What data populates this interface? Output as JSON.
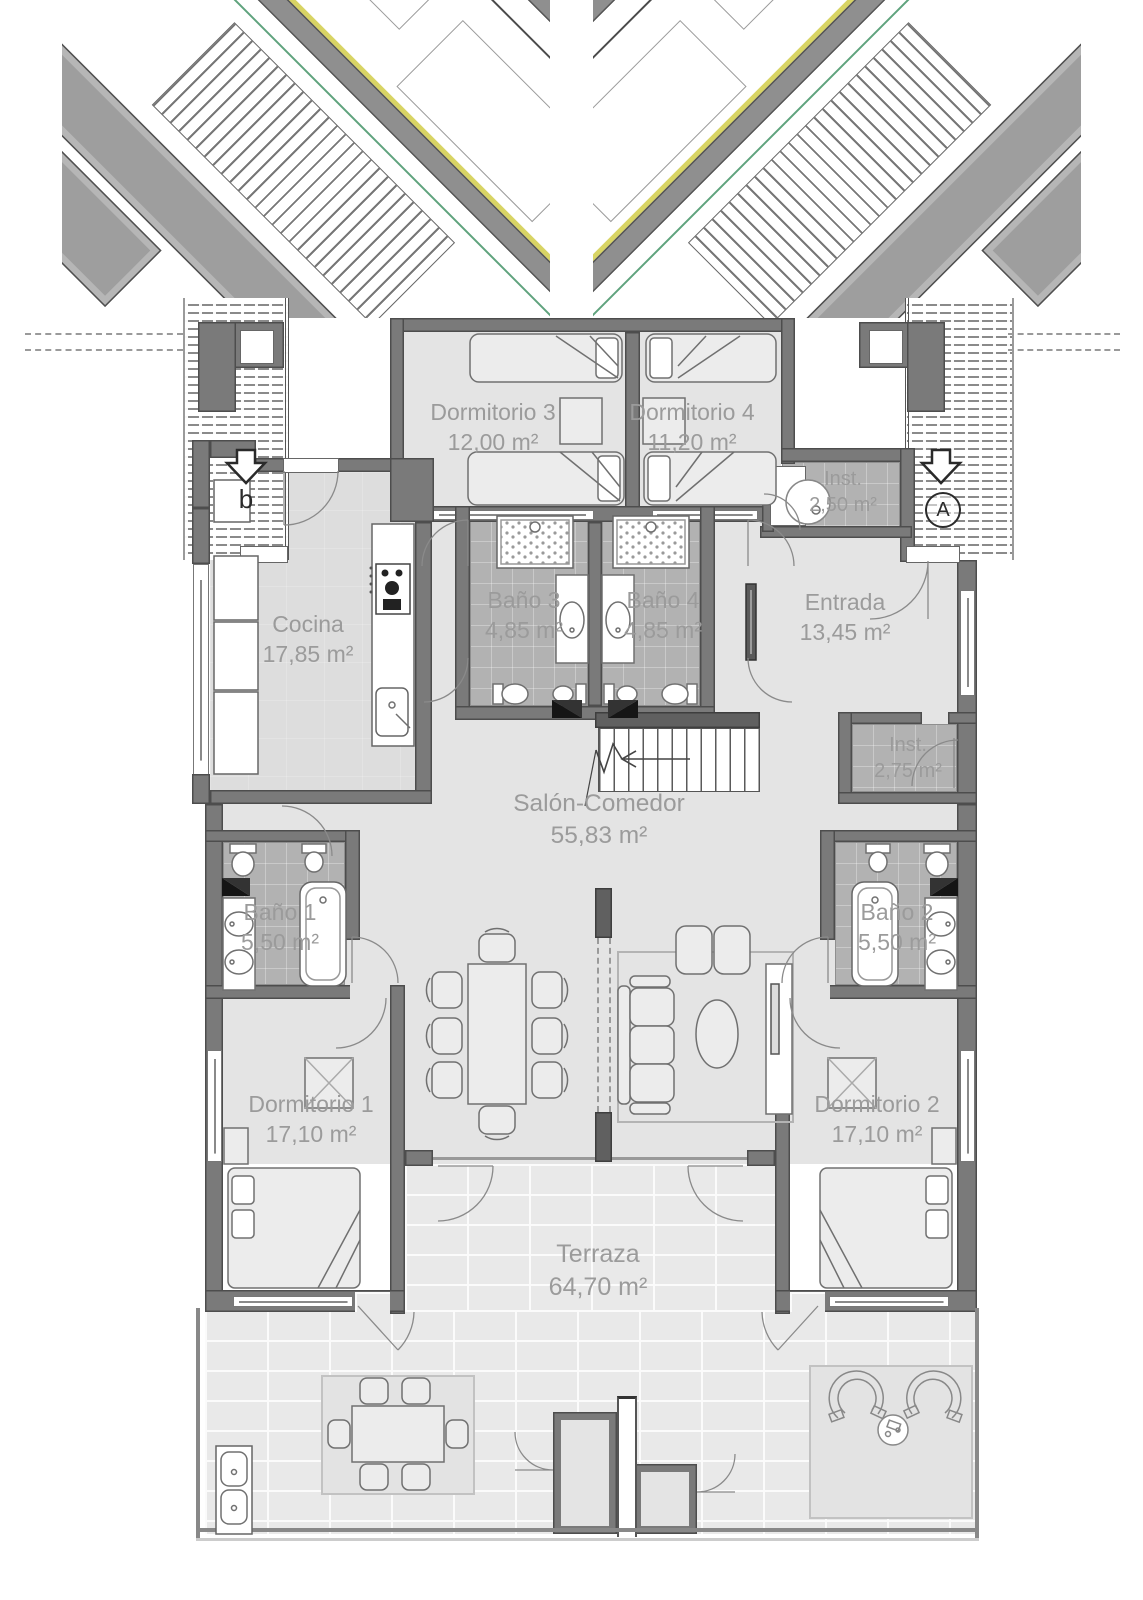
{
  "plan": {
    "title": "apartment-floor-plan",
    "markers": {
      "left": {
        "letter": "b",
        "icon": "down-arrow-icon"
      },
      "right": {
        "letter": "A",
        "icon": "down-arrow-icon"
      }
    },
    "rooms": [
      {
        "id": "dormitorio-3",
        "name": "Dormitorio 3",
        "area": "12,00 m²"
      },
      {
        "id": "dormitorio-4",
        "name": "Dormitorio 4",
        "area": "11,20 m²"
      },
      {
        "id": "inst-top",
        "name": "Inst.",
        "area": "2,50 m²"
      },
      {
        "id": "cocina",
        "name": "Cocina",
        "area": "17,85 m²"
      },
      {
        "id": "bano-3",
        "name": "Baño 3",
        "area": "4,85 m²"
      },
      {
        "id": "bano-4",
        "name": "Baño 4",
        "area": "4,85 m²"
      },
      {
        "id": "entrada",
        "name": "Entrada",
        "area": "13,45 m²"
      },
      {
        "id": "inst-mid",
        "name": "Inst.",
        "area": "2,75 m²"
      },
      {
        "id": "salon-comedor",
        "name": "Salón-Comedor",
        "area": "55,83 m²"
      },
      {
        "id": "bano-1",
        "name": "Baño 1",
        "area": "5,50 m²"
      },
      {
        "id": "bano-2",
        "name": "Baño 2",
        "area": "5,50 m²"
      },
      {
        "id": "dormitorio-1",
        "name": "Dormitorio 1",
        "area": "17,10 m²"
      },
      {
        "id": "dormitorio-2",
        "name": "Dormitorio 2",
        "area": "17,10 m²"
      },
      {
        "id": "terraza",
        "name": "Terraza",
        "area": "64,70 m²"
      }
    ],
    "colors": {
      "wall": "#7a7a7a",
      "floor": "#e4e4e4",
      "bath_tile": "#b2b2b2",
      "terrace_tile": "#e9e9e9",
      "accent_green": "#5fa37d",
      "accent_yellow": "#d8d464",
      "label_text": "#9b9b9b"
    }
  }
}
